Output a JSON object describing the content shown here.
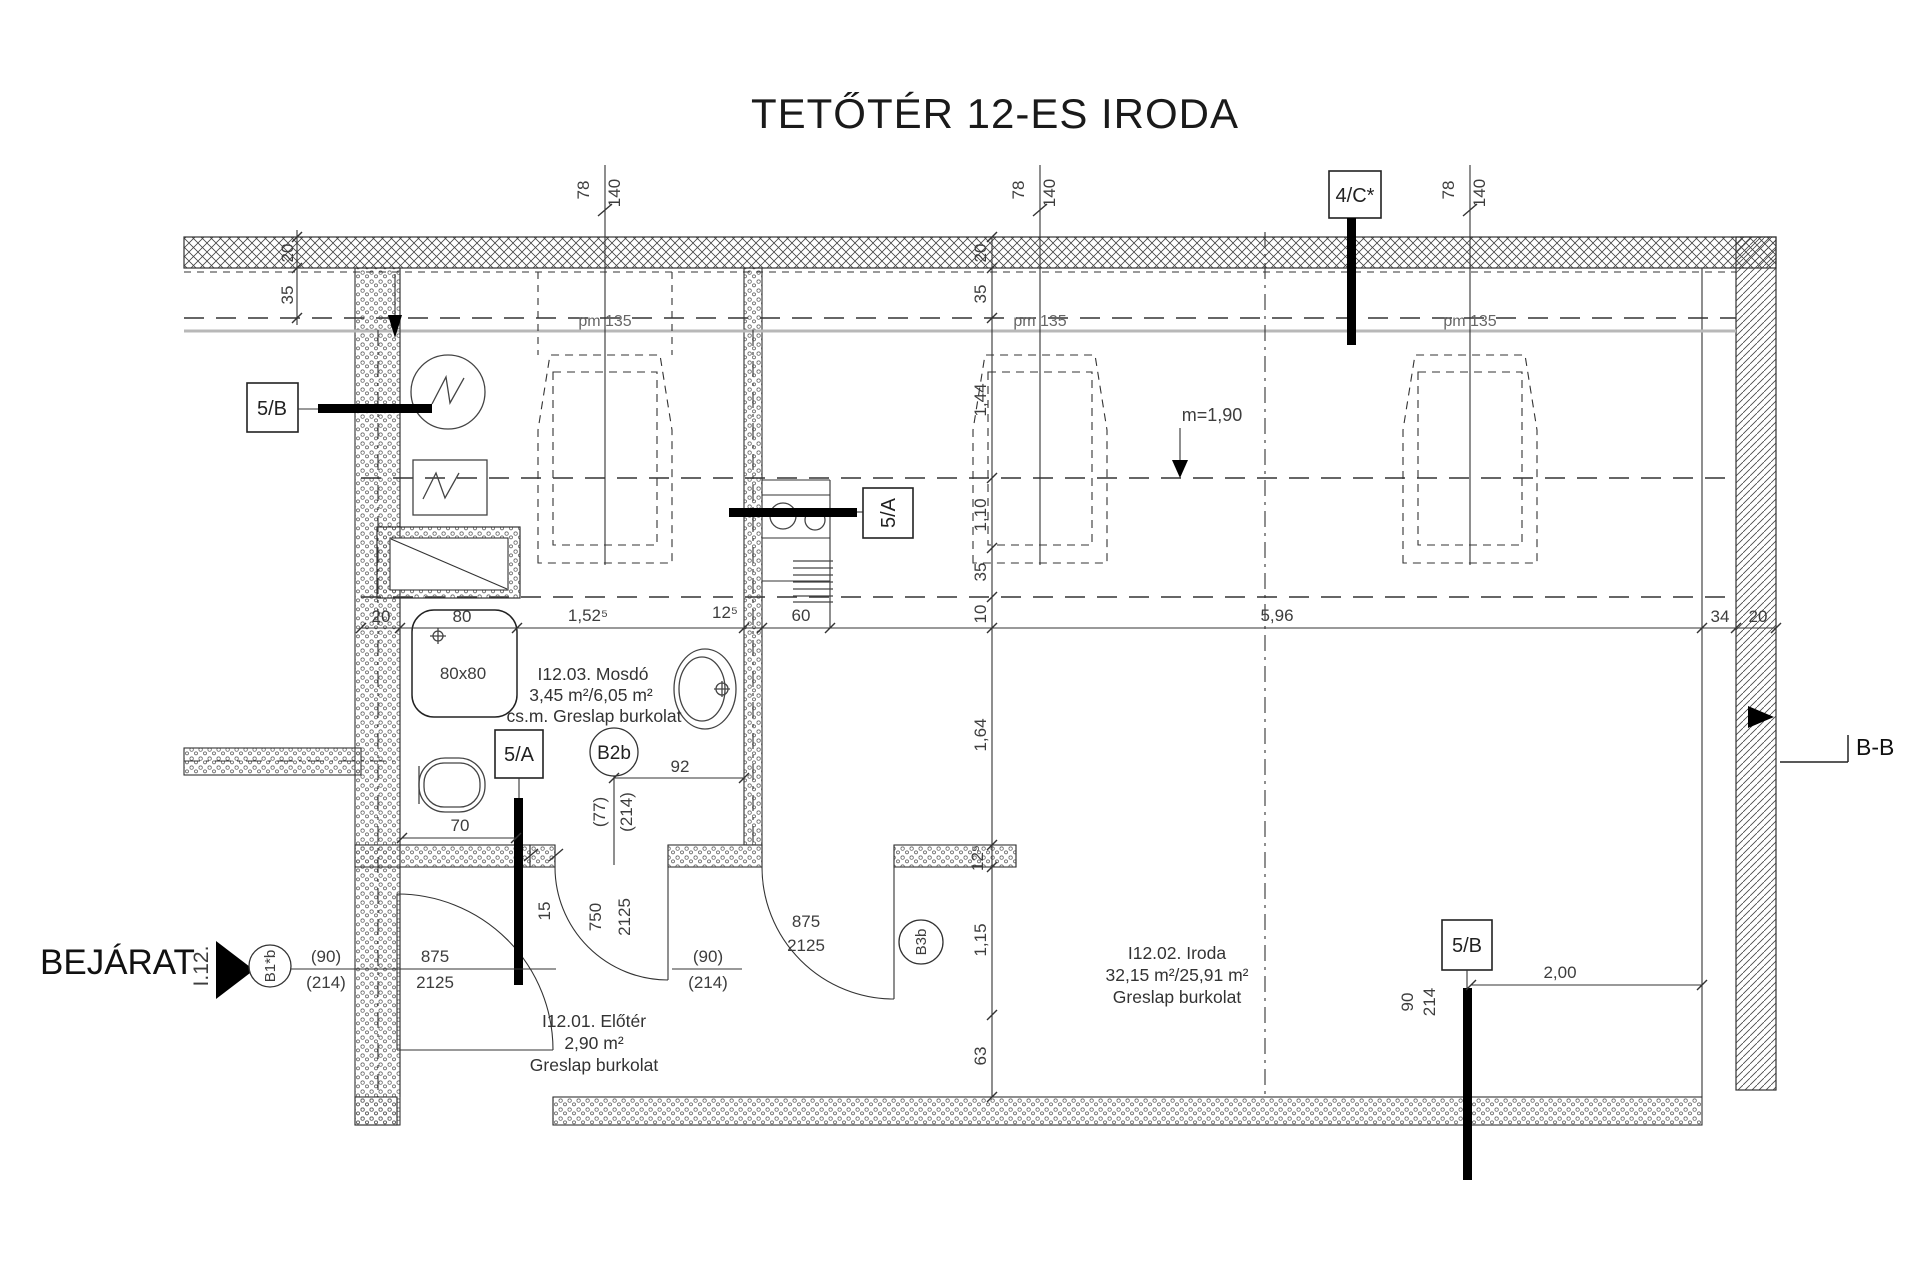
{
  "title": "TETŐTÉR 12-ES IRODA",
  "entrance": {
    "label": "BEJÁRAT",
    "axis": "I.12.",
    "door_mark": "B1*b"
  },
  "rooms": {
    "mosdo": {
      "line1": "I12.03. Mosdó",
      "line2": "3,45 m²/6,05 m²",
      "line3": "cs.m. Greslap burkolat"
    },
    "eloter": {
      "line1": "I12.01. Előtér",
      "line2": "2,90 m²",
      "line3": "Greslap burkolat"
    },
    "iroda": {
      "line1": "I12.02. Iroda",
      "line2": "32,15 m²/25,91 m²",
      "line3": "Greslap  burkolat"
    }
  },
  "markers": {
    "s5b": "5/B",
    "s5a": "5/A",
    "s4c": "4/C*",
    "b2b": "B2b",
    "b3b": "B3b"
  },
  "annotations": {
    "pm": "pm 135",
    "m_height": "m=1,90",
    "section_bb": "B-B"
  },
  "windows": {
    "w": "78",
    "h": "140"
  },
  "fixtures": {
    "shower_label": "80x80"
  },
  "dims": {
    "left": {
      "d20": "20",
      "d35": "35"
    },
    "h": {
      "d20": "20",
      "d80": "80",
      "d152": "1,52⁵",
      "d125": "12⁵",
      "d60": "60",
      "d596": "5,96",
      "d34": "34",
      "d20b": "20"
    },
    "v": {
      "v20": "20",
      "v35": "35",
      "v144": "1,44",
      "v110": "1,10",
      "v35b": "35",
      "v10": "10",
      "v164": "1,64",
      "v125": "12⁵",
      "v115": "1,15",
      "v63": "63"
    },
    "wc_width": "70",
    "sink_offset": "92",
    "niche": {
      "w": "(77)",
      "h": "(214)"
    },
    "pier": "15",
    "door_entry": {
      "w": "(90)",
      "h": "(214)",
      "leaf_w": "875",
      "leaf_h": "2125"
    },
    "door_b3b": {
      "w": "(90)",
      "h": "(214)",
      "leaf_w": "875",
      "leaf_h": "2125"
    },
    "door_wc": {
      "leaf_w": "750",
      "leaf_h": "2125"
    },
    "win_right": {
      "d90": "90",
      "d214": "214",
      "d200": "2,00"
    }
  },
  "colors": {
    "line": "#333333",
    "roof_line_gray": "#b8b8b8",
    "paper": "#ffffff"
  }
}
